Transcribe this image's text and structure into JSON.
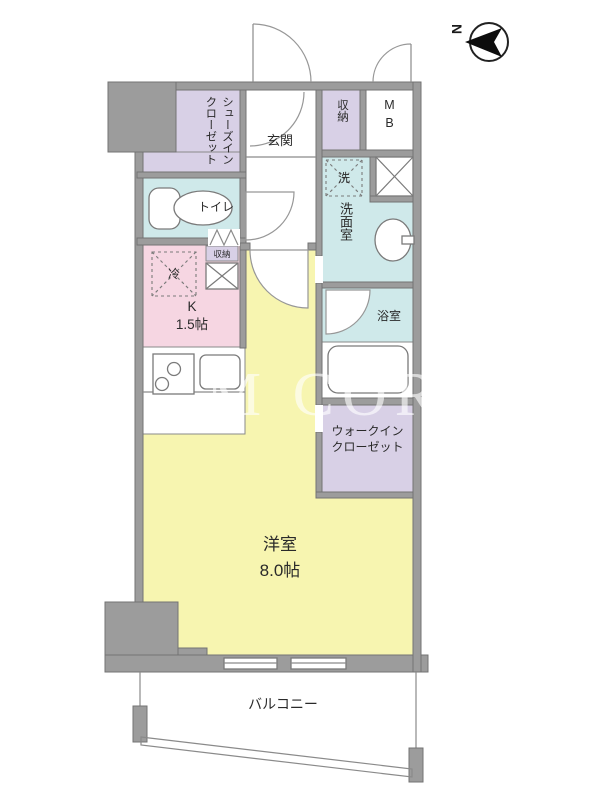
{
  "compass": {
    "label": "N"
  },
  "watermark": "M COR",
  "colors": {
    "wall": "#9c9c9c",
    "closet_purple": "#d8d0e6",
    "wet_cyan": "#cfe9ea",
    "kitchen_pink": "#f6d6e2",
    "room_yellow": "#f7f5b0",
    "white": "#ffffff"
  },
  "rooms": {
    "shoe_closet": "シューズイン\nクローゼット",
    "entrance": "玄関",
    "storage": "収納",
    "meter_box": "M\nB",
    "washer": "洗",
    "washroom": "洗面室",
    "toilet": "トイレ",
    "fridge": "冷",
    "kitchen": "K\n1.5帖",
    "kitchen_storage": "収納",
    "bathroom": "浴室",
    "walk_in_closet": "ウォークイン\nクローゼット",
    "main_room": "洋室\n8.0帖",
    "balcony": "バルコニー"
  }
}
